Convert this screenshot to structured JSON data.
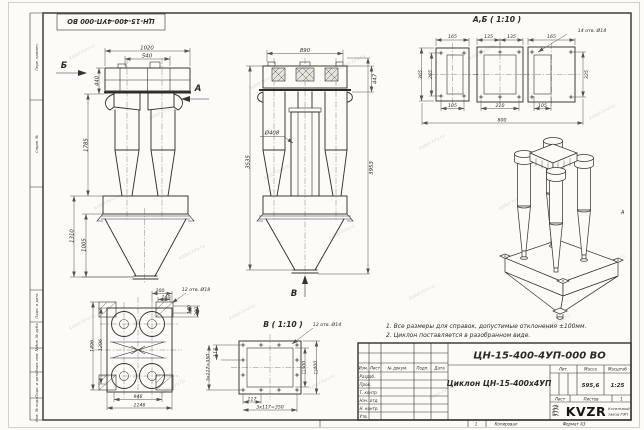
{
  "sheet": {
    "stamp": "ЦН-15-400-4УП-000 ВО",
    "watermark": "kotel-hrv.ru",
    "zone_marker": "А",
    "margin_labels": {
      "perv": "Перв. примен.",
      "sprav": "Справ. №",
      "podp1": "Подп. и дата",
      "inv_dubl": "Инв. № дубл.",
      "vzam": "Взам. инв. №",
      "podp2": "Подп. и дата",
      "inv_podl": "Инв. № подл."
    },
    "footer": {
      "sheet_no": "1",
      "copied": "Копировал",
      "format": "Формат А3"
    }
  },
  "notes": {
    "line1": "1. Все размеры для справок, допустимые отклонения ±100мм.",
    "line2": "2. Циклон поставляется в разобранном виде."
  },
  "front_view": {
    "arrow_b": "Б",
    "arrow_a": "А",
    "dims": {
      "w1020": "1020",
      "w540": "540",
      "h440": "440",
      "h1785": "1785",
      "h1310": "1310",
      "h1005": "1005"
    }
  },
  "main_view": {
    "arrow_v": "В",
    "dims": {
      "w890": "890",
      "h447": "447",
      "d408": "Ø408",
      "h3535": "3535",
      "h3953": "3953"
    }
  },
  "section_ab": {
    "title": "А,Б ( 1:10 )",
    "holes_note": "14 отв. Ø14",
    "dims": {
      "w165l": "165",
      "w135l": "135",
      "w135r": "135",
      "w165r": "165",
      "h365": "365",
      "h265": "265",
      "h325": "325",
      "w105l": "105",
      "w210": "210",
      "w105r": "105",
      "w800": "800"
    }
  },
  "top_view": {
    "holes_note": "12 отв. Ø18",
    "dims": {
      "w200": "200",
      "w140": "140",
      "h140": "140",
      "h200": "200",
      "h1496": "1496",
      "h1296": "1296",
      "w946": "946",
      "w1146": "1146"
    }
  },
  "flange_view": {
    "title": "В ( 1:10 )",
    "holes_note": "12 отв. Ø14",
    "dims": {
      "s300": "□300",
      "s400": "□400",
      "w117": "117",
      "w350": "3х117=350",
      "h117": "117",
      "h350": "3х117=350"
    }
  },
  "title_block": {
    "designation": "ЦН-15-400-4УП-000 ВО",
    "product_name": "Циклон ЦН-15-400х4УП",
    "col_izm": "Изм.",
    "col_list": "Лист",
    "col_doc": "№ докум.",
    "col_podp": "Подп.",
    "col_data": "Дата",
    "row_razrab": "Разраб.",
    "row_prov": "Пров.",
    "row_tkontr": "Т. контр.",
    "row_nachotd": "Нач. отд.",
    "row_nkontr": "Н. контр.",
    "row_utv": "Утв.",
    "lit_header": "Лит.",
    "mass_header": "Масса",
    "scale_header": "Масштаб",
    "mass_value": "595,6",
    "scale_value": "1:25",
    "list_label": "Лист",
    "listov_label": "Листов",
    "listov_value": "1",
    "logo_text": "KVZR",
    "company_line1": "Котельный",
    "company_line2": "завод РЭП"
  }
}
